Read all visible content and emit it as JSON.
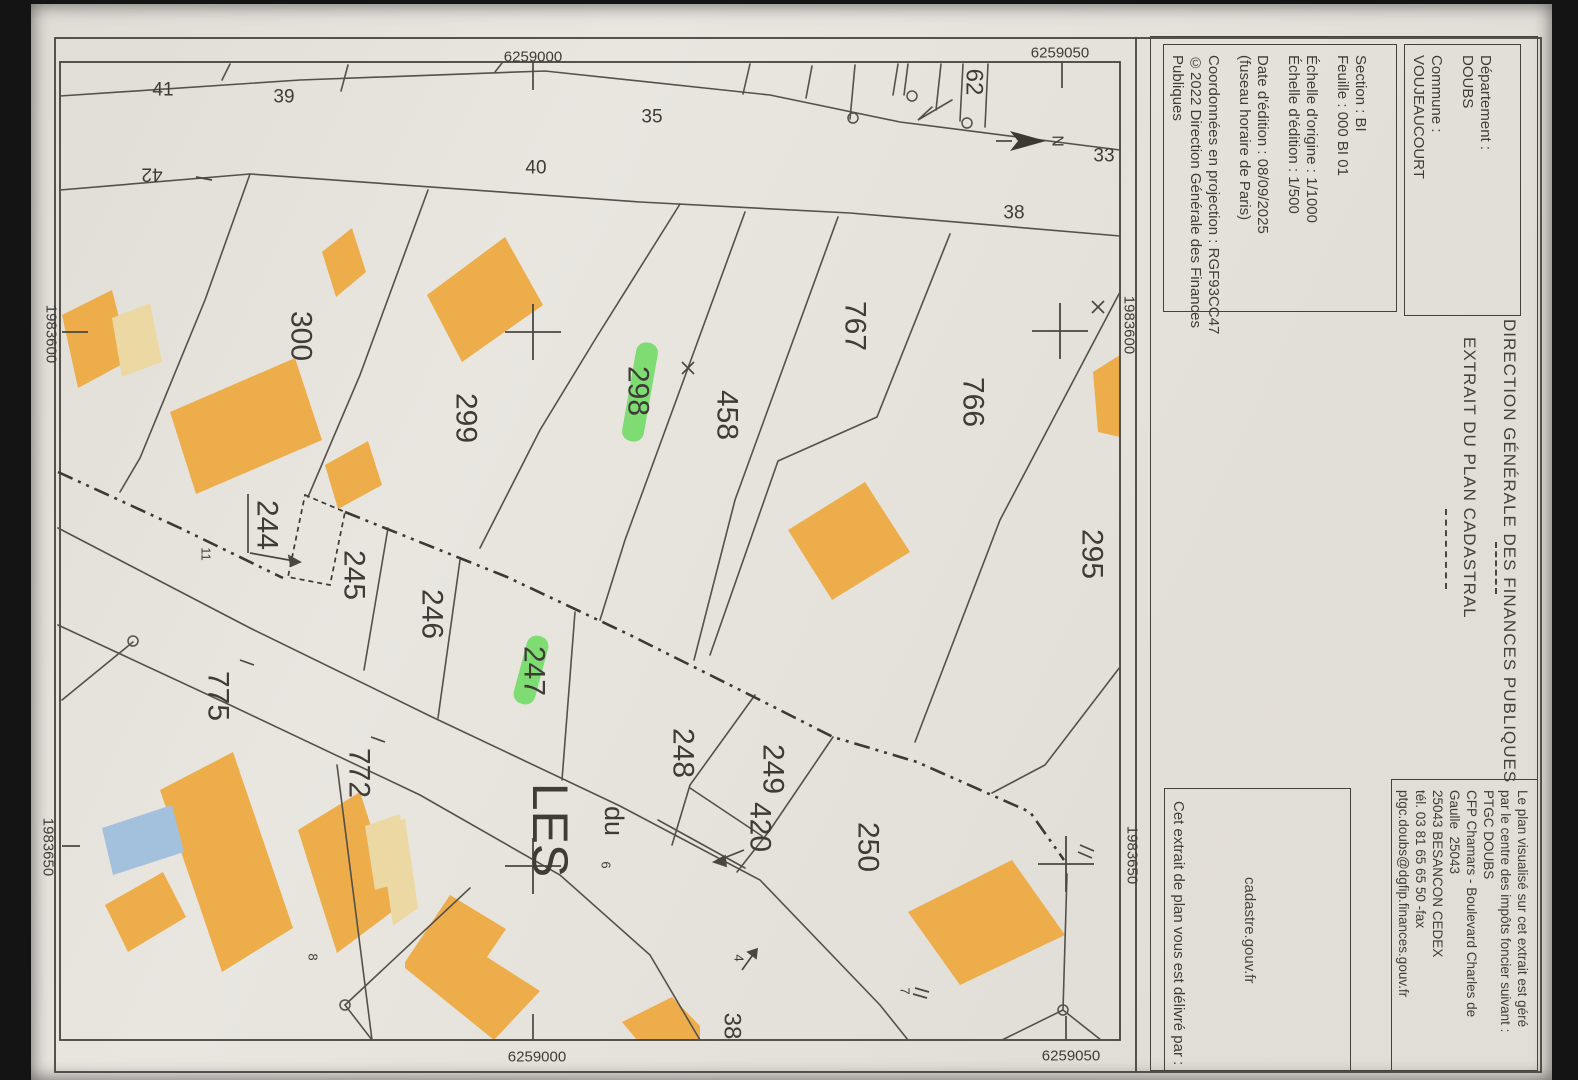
{
  "panels": {
    "department_label": "Département :",
    "department_value": "DOUBS",
    "commune_label": "Commune :",
    "commune_value": "VOUJEAUCOURT",
    "info_lines": [
      "Section : BI",
      "Feuille : 000 BI 01",
      "Échelle d'origine : 1/1000",
      "Échelle d'édition : 1/500",
      "Date d'édition : 08/09/2025",
      "(fuseau horaire de Paris)",
      "Coordonnées en projection : RGF93CC47",
      "©2022 Direction Générale des Finances",
      "Publiques"
    ],
    "title1": "DIRECTION GÉNÉRALE DES FINANCES PUBLIQUES",
    "title2": "EXTRAIT DU PLAN CADASTRAL",
    "center_lines": [
      "Le plan visualisé sur cet extrait est géré",
      "par le centre des impôts foncier suivant :",
      "PTGC DOUBS",
      "CFP Chamars - Boulevard Charles de",
      "Gaulle  25043",
      "25043 BESANCON CEDEX",
      "tél. 03 81 65 65 50 -fax",
      "ptgc.doubs@dgfip.finances.gouv.fr"
    ],
    "delivery_intro": "Cet extrait de plan vous est délivré par :",
    "delivery_site": "cadastre.gouv.fr"
  },
  "map": {
    "colors": {
      "building": "#eead4b",
      "building_light": "#ecd8a3",
      "building_blue": "#a3c0dc",
      "highlight": "#55d84a"
    },
    "labels": [
      {
        "t": "6259000",
        "x": 533,
        "y": 57,
        "s": 15,
        "n": "grid-coordinate-label"
      },
      {
        "t": "6259050",
        "x": 1060,
        "y": 53,
        "s": 15,
        "n": "grid-coordinate-label"
      },
      {
        "t": "6259000",
        "x": 537,
        "y": 1057,
        "s": 15,
        "n": "grid-coordinate-label"
      },
      {
        "t": "6259050",
        "x": 1071,
        "y": 1056,
        "s": 15,
        "n": "grid-coordinate-label"
      },
      {
        "t": "1983600",
        "x": 51,
        "y": 334,
        "r": 90,
        "s": 15,
        "n": "grid-coordinate-label"
      },
      {
        "t": "1983650",
        "x": 48,
        "y": 847,
        "r": 90,
        "s": 15,
        "n": "grid-coordinate-label"
      },
      {
        "t": "1983600",
        "x": 1129,
        "y": 325,
        "r": 90,
        "s": 15,
        "n": "grid-coordinate-label"
      },
      {
        "t": "1983650",
        "x": 1132,
        "y": 855,
        "r": 90,
        "s": 15,
        "n": "grid-coordinate-label"
      },
      {
        "t": "41",
        "x": 163,
        "y": 90,
        "s": 19
      },
      {
        "t": "39",
        "x": 284,
        "y": 97,
        "s": 19
      },
      {
        "t": "35",
        "x": 652,
        "y": 117,
        "s": 19
      },
      {
        "t": "40",
        "x": 536,
        "y": 168,
        "s": 19
      },
      {
        "t": "33",
        "x": 1104,
        "y": 156,
        "s": 19
      },
      {
        "t": "38",
        "x": 1014,
        "y": 213,
        "s": 19
      },
      {
        "t": "42",
        "x": 152,
        "y": 174,
        "r": 180,
        "s": 19
      },
      {
        "t": "62",
        "x": 974,
        "y": 82,
        "r": 90,
        "s": 24
      },
      {
        "t": "300",
        "x": 301,
        "y": 336,
        "r": 90,
        "s": 30
      },
      {
        "t": "299",
        "x": 466,
        "y": 418,
        "r": 90,
        "s": 30
      },
      {
        "t": "298",
        "x": 638,
        "y": 391,
        "r": 90,
        "s": 30
      },
      {
        "t": "458",
        "x": 727,
        "y": 415,
        "r": 90,
        "s": 30
      },
      {
        "t": "767",
        "x": 855,
        "y": 326,
        "r": 90,
        "s": 30
      },
      {
        "t": "766",
        "x": 973,
        "y": 402,
        "r": 90,
        "s": 30
      },
      {
        "t": "295",
        "x": 1092,
        "y": 554,
        "r": 90,
        "s": 30
      },
      {
        "t": "244",
        "x": 267,
        "y": 525,
        "r": 90,
        "s": 30
      },
      {
        "t": "245",
        "x": 354,
        "y": 575,
        "r": 90,
        "s": 30
      },
      {
        "t": "246",
        "x": 432,
        "y": 614,
        "r": 90,
        "s": 30
      },
      {
        "t": "247",
        "x": 534,
        "y": 671,
        "r": 90,
        "s": 30
      },
      {
        "t": "248",
        "x": 683,
        "y": 753,
        "r": 90,
        "s": 30
      },
      {
        "t": "249",
        "x": 773,
        "y": 769,
        "r": 90,
        "s": 30
      },
      {
        "t": "420",
        "x": 760,
        "y": 827,
        "r": 90,
        "s": 30
      },
      {
        "t": "250",
        "x": 868,
        "y": 847,
        "r": 90,
        "s": 30
      },
      {
        "t": "775",
        "x": 218,
        "y": 696,
        "r": 90,
        "s": 30
      },
      {
        "t": "772",
        "x": 359,
        "y": 773,
        "r": 90,
        "s": 30
      },
      {
        "t": "38",
        "x": 732,
        "y": 1026,
        "r": 90,
        "s": 24
      },
      {
        "t": "LES",
        "x": 550,
        "y": 830,
        "r": 90,
        "s": 50,
        "n": "street-label"
      },
      {
        "t": "du",
        "x": 614,
        "y": 821,
        "r": 90,
        "s": 27,
        "n": "street-label"
      },
      {
        "t": "11",
        "x": 206,
        "y": 554,
        "r": 90,
        "s": 13,
        "n": "house-number-label"
      },
      {
        "t": "8",
        "x": 313,
        "y": 957,
        "r": 90,
        "s": 13,
        "n": "house-number-label"
      },
      {
        "t": "4",
        "x": 739,
        "y": 958,
        "r": 90,
        "s": 13,
        "n": "house-number-label"
      },
      {
        "t": "7",
        "x": 905,
        "y": 991,
        "r": 90,
        "s": 13,
        "n": "house-number-label"
      },
      {
        "t": "6",
        "x": 606,
        "y": 865,
        "r": 90,
        "s": 13,
        "n": "house-number-label"
      },
      {
        "t": "N",
        "x": 1057,
        "y": 141,
        "r": 90,
        "s": 16,
        "n": "north-label"
      }
    ]
  }
}
